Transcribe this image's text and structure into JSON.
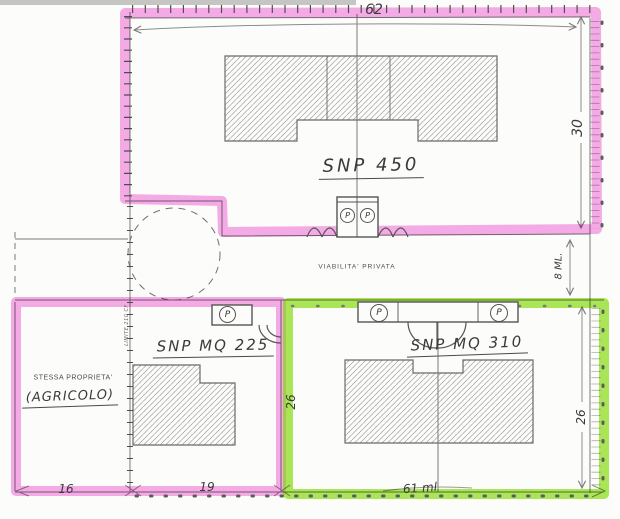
{
  "site_plan": {
    "road": {
      "label": "VIABILITA' PRIVATA",
      "width_dim": "8 ML."
    },
    "parcel_top": {
      "label": "SNP 450",
      "top_dim": "62",
      "right_dim": "30"
    },
    "parcel_bottom_left": {
      "label": "SNP MQ 225",
      "owner_title": "STESSA PROPRIETA'",
      "owner_note": "(AGRICOLO)",
      "limit_label": "LIMITE 210 CF",
      "bottom_dim_left": "16",
      "bottom_dim_right": "19"
    },
    "parcel_bottom_right": {
      "label": "SNP MQ 310",
      "left_dim": "26",
      "right_dim": "26",
      "bottom_dim": "61 ml"
    },
    "parking_letter": "P",
    "colors": {
      "highlight_pink": "#f06ad8",
      "highlight_green": "#7edb00",
      "ink": "#6e6e6e"
    }
  }
}
